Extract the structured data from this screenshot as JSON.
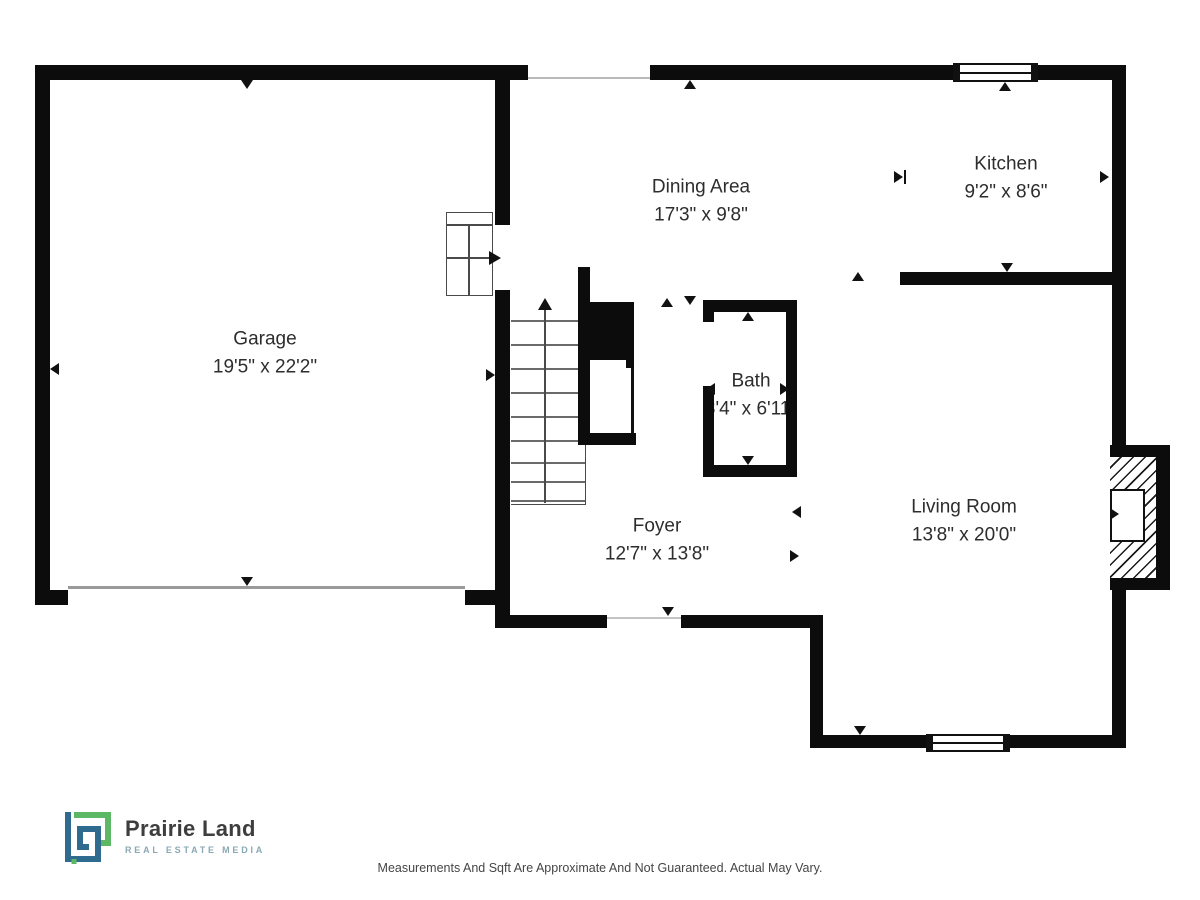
{
  "floorplan": {
    "rooms": [
      {
        "name": "Garage",
        "dims": "19'5\" x 22'2\""
      },
      {
        "name": "Dining Area",
        "dims": "17'3\" x 9'8\""
      },
      {
        "name": "Kitchen",
        "dims": "9'2\" x 8'6\""
      },
      {
        "name": "Bath",
        "dims": "3'4\" x 6'11\""
      },
      {
        "name": "Foyer",
        "dims": "12'7\" x 13'8\""
      },
      {
        "name": "Living Room",
        "dims": "13'8\" x 20'0\""
      }
    ]
  },
  "logo": {
    "name": "Prairie Land",
    "tagline": "REAL ESTATE MEDIA"
  },
  "footer": {
    "disclaimer": "Measurements And Sqft Are Approximate And Not Guaranteed. Actual May Vary."
  },
  "colors": {
    "wall": "#0c0c0c",
    "logo_blue": "#2f6b8f",
    "logo_green": "#5cb865",
    "tagline_teal": "#8aa9b4"
  }
}
